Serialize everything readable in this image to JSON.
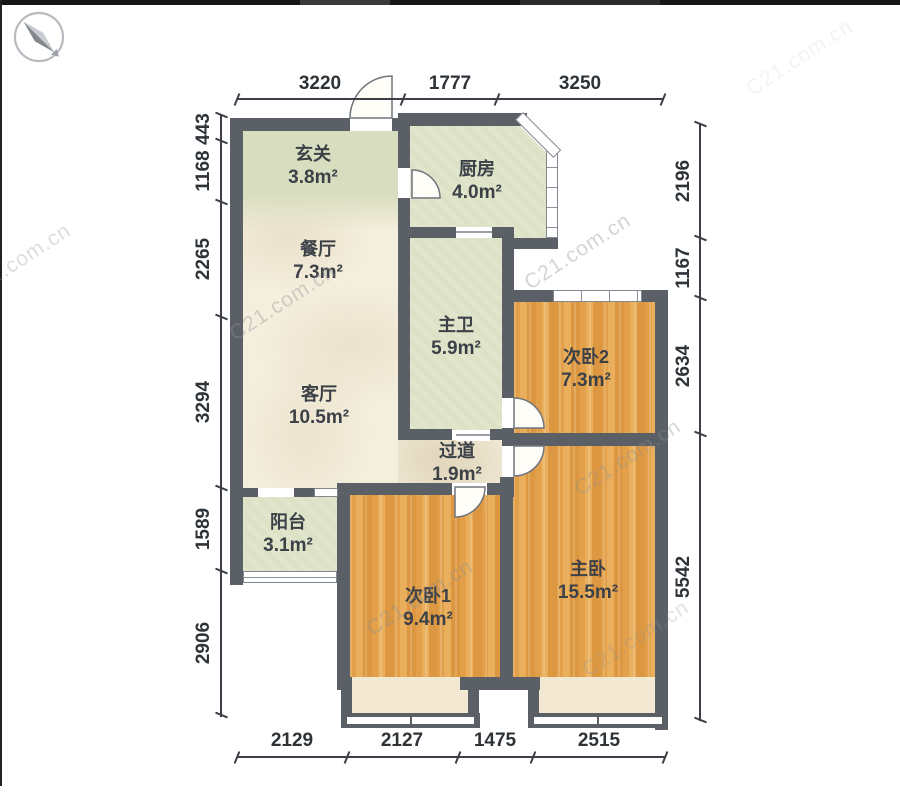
{
  "canvas": {
    "width": 900,
    "height": 807
  },
  "watermark": {
    "text": "C21.com.cn"
  },
  "rooms": [
    {
      "id": "entry",
      "name": "玄关",
      "area": "3.8m²"
    },
    {
      "id": "kitchen",
      "name": "厨房",
      "area": "4.0m²"
    },
    {
      "id": "dining",
      "name": "餐厅",
      "area": "7.3m²"
    },
    {
      "id": "master-bath",
      "name": "主卫",
      "area": "5.9m²"
    },
    {
      "id": "bedroom2",
      "name": "次卧2",
      "area": "7.3m²"
    },
    {
      "id": "living",
      "name": "客厅",
      "area": "10.5m²"
    },
    {
      "id": "hallway",
      "name": "过道",
      "area": "1.9m²"
    },
    {
      "id": "balcony",
      "name": "阳台",
      "area": "3.1m²"
    },
    {
      "id": "bedroom1",
      "name": "次卧1",
      "area": "9.4m²"
    },
    {
      "id": "master-bedroom",
      "name": "主卧",
      "area": "15.5m²"
    }
  ],
  "dims": {
    "top": [
      "3220",
      "1777",
      "3250"
    ],
    "left": [
      "443",
      "1168",
      "2265",
      "3294",
      "1589",
      "2906"
    ],
    "right": [
      "2196",
      "1167",
      "2634",
      "5542"
    ],
    "bottom": [
      "2129",
      "2127",
      "1475",
      "2515"
    ]
  },
  "colors": {
    "wall": "#5b6067",
    "floor_tile": "#f4eedd",
    "floor_green": "#dde2c6",
    "floor_wood": "#e6a44e",
    "bay_window": "#f3e9d2",
    "dim_text": "#2e3338"
  }
}
